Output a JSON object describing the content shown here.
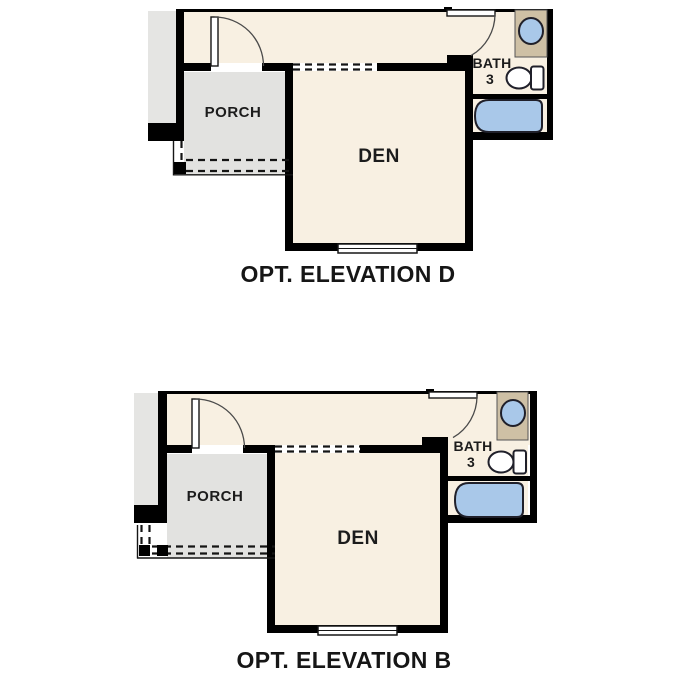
{
  "plans": [
    {
      "caption": "OPT. ELEVATION D",
      "porch_label": "PORCH",
      "den_label": "DEN",
      "bath_label": "BATH",
      "bath_number": "3"
    },
    {
      "caption": "OPT. ELEVATION B",
      "porch_label": "PORCH",
      "den_label": "DEN",
      "bath_label": "BATH",
      "bath_number": "3"
    }
  ],
  "colors": {
    "wall": "#000000",
    "interior": "#f8f0e2",
    "porch": "#e2e2e0",
    "exterior_strip": "#e5e5e3",
    "counter": "#cec0a5",
    "fixture_blue": "#a9c8e9",
    "fixture_white": "#ffffff"
  }
}
